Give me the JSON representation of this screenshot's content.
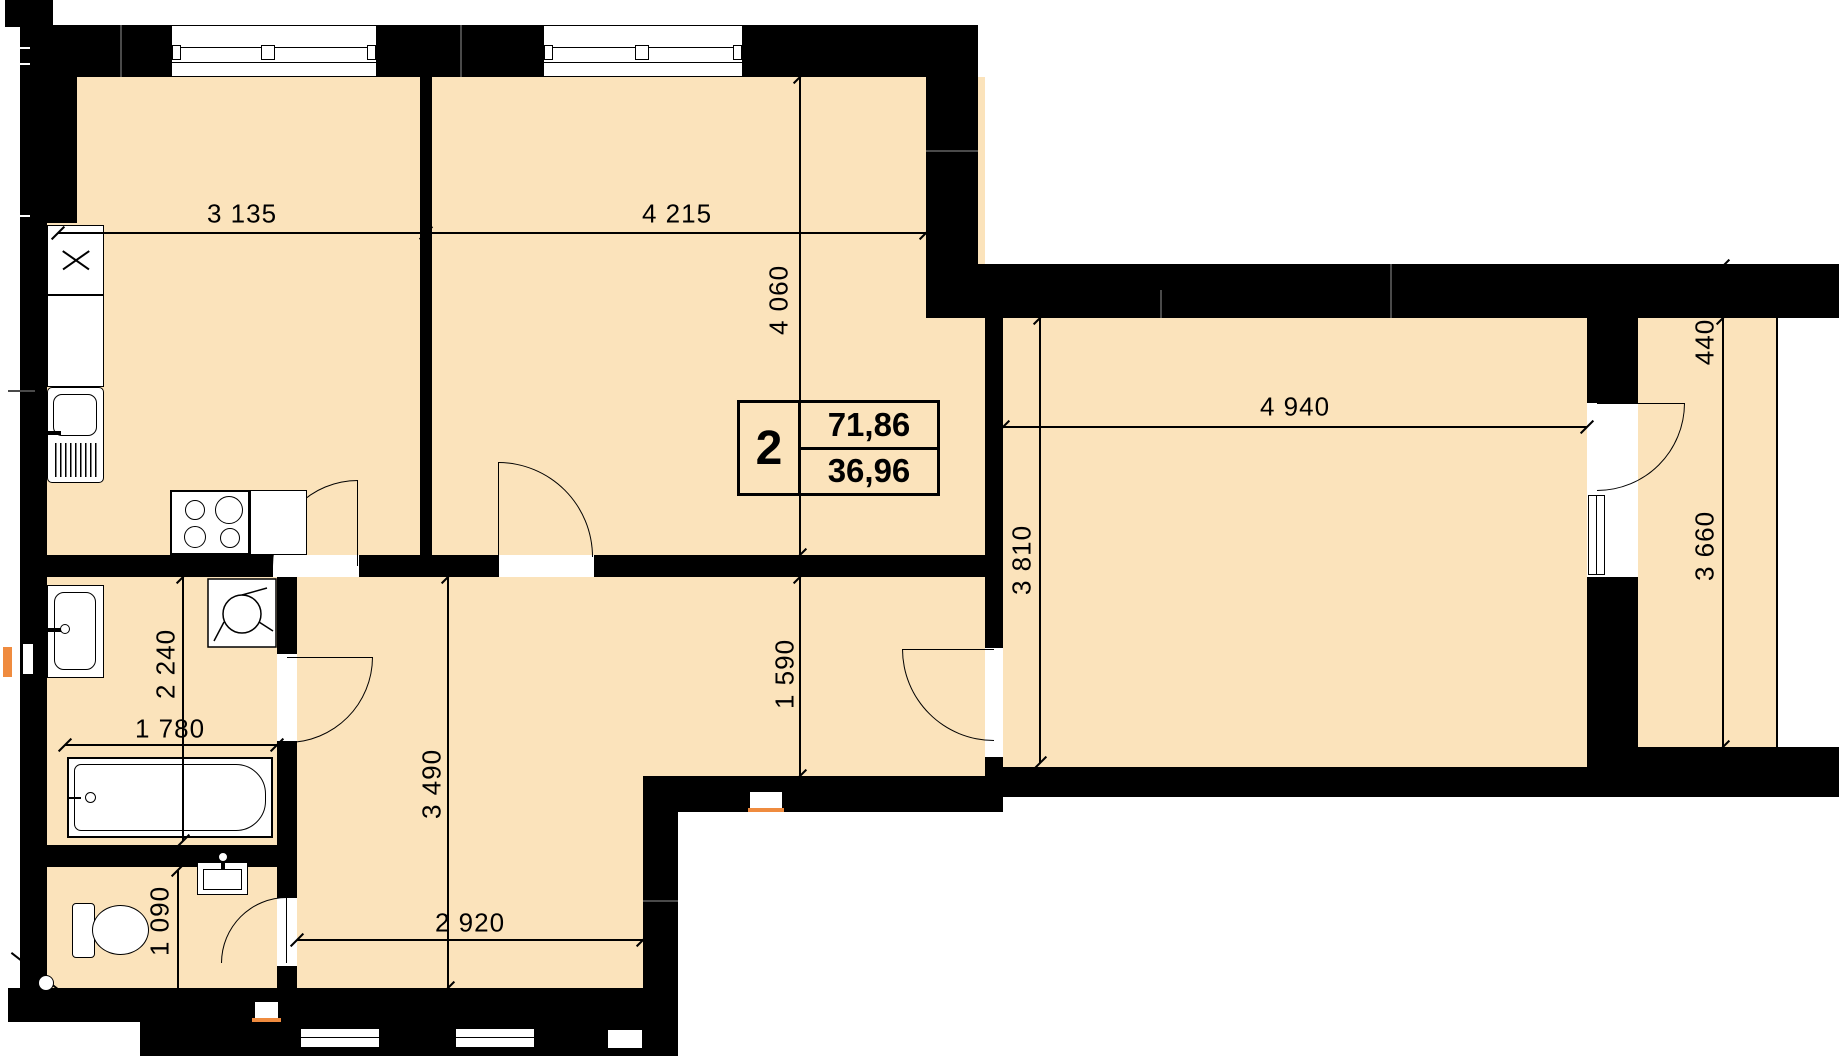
{
  "floorplan": {
    "title": "2-room apartment plan",
    "unit_stamp": {
      "room_count": "2",
      "total_area": "71,86",
      "living_area": "36,96"
    },
    "dimensions_mm": {
      "kitchen_width": "3 135",
      "bedroom_width": "4 215",
      "bedroom_depth": "4 060",
      "living_room_width": "4 940",
      "living_room_depth": "3 810",
      "balcony_wall": "440",
      "balcony_length": "3 660",
      "hall_upper_depth": "1 590",
      "hall_depth": "3 490",
      "hall_width": "2 920",
      "bathroom_depth": "2 240",
      "bathroom_width": "1 780",
      "wc_depth": "1 090"
    },
    "colors": {
      "floor": "#FBE3BB",
      "walls": "#000000",
      "accent": "#EF8B3F",
      "background": "#FFFFFF"
    },
    "fixtures": [
      "kitchen-unit-x",
      "kitchen-counter",
      "kitchen-sink",
      "stove",
      "base-cabinet",
      "ventilation-fan",
      "washbasin",
      "bathtub",
      "toilet",
      "wc-washbasin"
    ]
  }
}
